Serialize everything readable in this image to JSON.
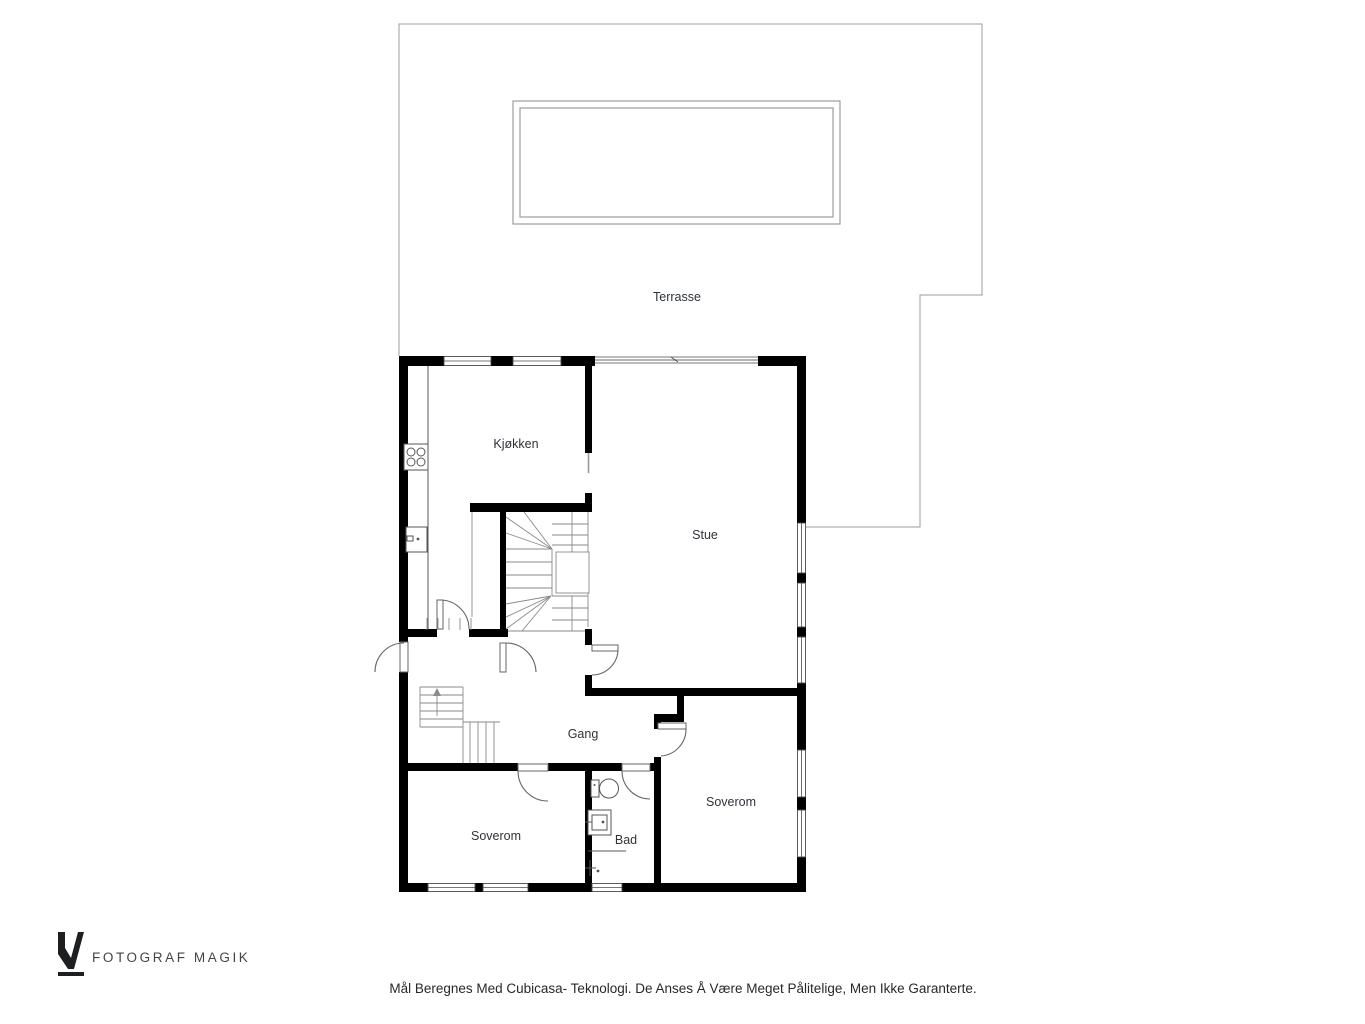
{
  "colors": {
    "wall": "#000000",
    "label": "#2e3338",
    "logo": "#1d1f21"
  },
  "rooms": {
    "terrasse": "Terrasse",
    "kjokken": "Kjøkken",
    "stue": "Stue",
    "gang": "Gang",
    "soverom_left": "Soverom",
    "bad": "Bad",
    "soverom_right": "Soverom"
  },
  "branding": {
    "logo_text": "FOTOGRAF MAGIK"
  },
  "footer": {
    "disclaimer": "Mål Beregnes Med Cubicasa- Teknologi. De Anses Å Være Meget Pålitelige, Men Ikke Garanterte."
  }
}
